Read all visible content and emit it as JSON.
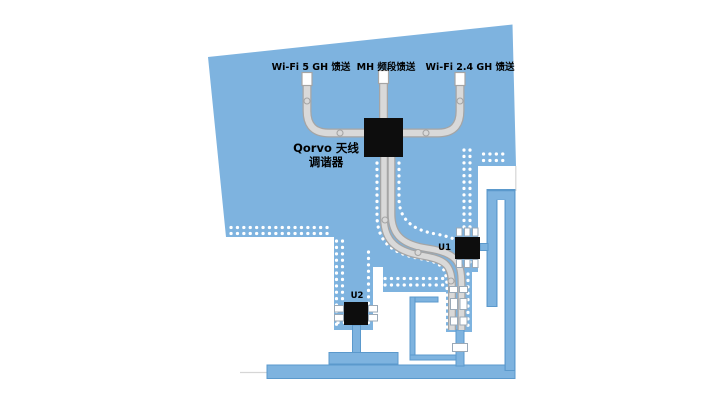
{
  "diagram": {
    "title_context": "Qorvo antenna tuner PCB layout diagram",
    "labels": {
      "feed_wifi5": "Wi-Fi 5 GH 馈送",
      "feed_mh": "MH 频段馈送",
      "feed_wifi24": "Wi-Fi 2.4 GH 馈送",
      "tuner_line1": "Qorvo 天线",
      "tuner_line2": "调谐器",
      "u1": "U1",
      "u2": "U2"
    },
    "colors": {
      "bg": "#FFFFFF",
      "board": "#7EB3DF",
      "outline": "#5B99CC",
      "trace": "#D9D9D9",
      "traceEdge": "#A5A5A5",
      "chip": "#0D0D0D",
      "via": "#FFFFFF",
      "padEdge": "#9AA9B7",
      "faint": "#D6D6D6",
      "text": "#000000"
    }
  }
}
